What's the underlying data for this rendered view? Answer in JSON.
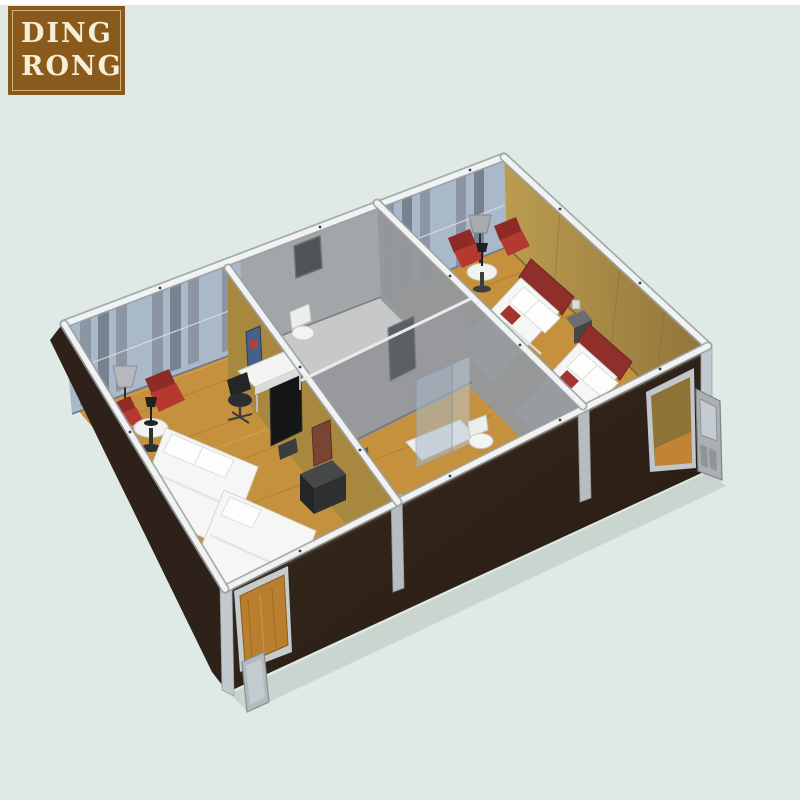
{
  "logo": {
    "line1": "DING",
    "line2": "RONG"
  },
  "alt": "3D cutaway rendering of a two-unit prefab container house: left bedroom with double beds, desk and TV, middle bathroom module with shower and toilets, right bedroom with two single beds, red armchairs, open doors on the dark brown exterior walls",
  "palette": {
    "bg": "#dfe9e5",
    "top-strip": "#fcfdfd",
    "logo-bg": "#8a5a1d",
    "logo-border": "#d2b37c",
    "logo-text": "#f6eed6",
    "wall-dark": "#32241b",
    "wall-dark-deep": "#241a12",
    "wall-tan": "#a8883f",
    "wall-tan-light": "#bb9c50",
    "wall-grey": "#a3a6a9",
    "wall-grey-mid": "#94979b",
    "curtain": "#8b95a3",
    "curtain-dark": "#77828f",
    "glass": "#a9b9ca",
    "wood": "#c6913c",
    "wood-dark": "#aa772a",
    "red": "#b53931",
    "red-dark": "#8e2b27",
    "headboard": "#8e2f2c",
    "bed-white": "#f6f7f5",
    "item-black": "#1d1f21",
    "silver": "#c3c9cc",
    "beam-white": "#f1f3f3"
  }
}
